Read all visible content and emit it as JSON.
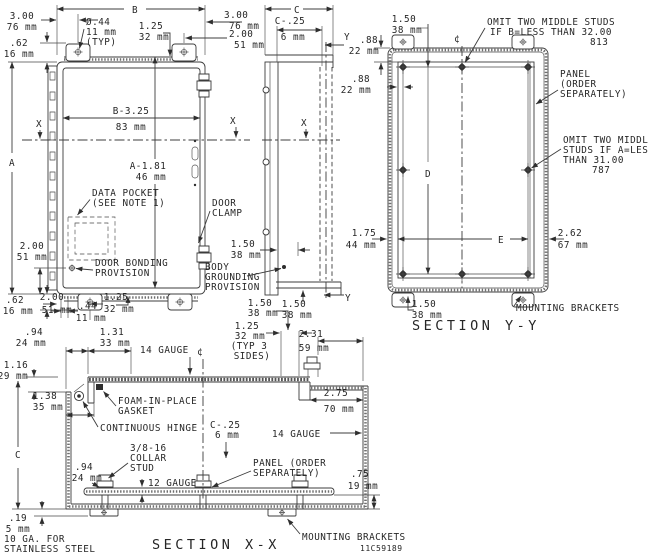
{
  "meta": {
    "drawing_number": "11C59189"
  },
  "front": {
    "dim_b": "B",
    "dim_a": "A",
    "d300_tl": [
      "3.00",
      "76 mm"
    ],
    "d62_tl": [
      ".62",
      "16 mm"
    ],
    "dia44": [
      "Ø.44",
      "11 mm",
      "(TYP)"
    ],
    "d125_top": [
      "1.25",
      "32 mm"
    ],
    "d300_tr": [
      "3.00",
      "76 mm"
    ],
    "d200_tr": [
      "2.00",
      "51 mm"
    ],
    "b325": [
      "B-3.25",
      "83 mm"
    ],
    "a181": [
      "A-1.81",
      "46 mm"
    ],
    "x_left": "X",
    "x_right": "X",
    "data_pocket": [
      "DATA POCKET",
      "(SEE NOTE 1)"
    ],
    "door_bonding": [
      "DOOR BONDING",
      "PROVISION"
    ],
    "d200_left": [
      "2.00",
      "51 mm"
    ],
    "d62_bl": [
      ".62",
      "16 mm"
    ],
    "d200_bl": [
      "2.00",
      "51 mm"
    ],
    "d44_b": [
      ".44",
      "11 mm"
    ],
    "d125_b": [
      "1.25",
      "32 mm"
    ],
    "door_clamp": [
      "DOOR",
      "CLAMP"
    ]
  },
  "side": {
    "dim_c": "C",
    "c25": [
      "C-.25",
      "6 mm"
    ],
    "y_top": "Y",
    "y_bottom": "Y",
    "x_side": "X",
    "d150_mid": [
      "1.50",
      "38 mm"
    ],
    "body_grounding": [
      "BODY",
      "GROUNDING",
      "PROVISION"
    ],
    "d150_bot": [
      "1.50",
      "38 mm"
    ]
  },
  "section_yy": {
    "title": "SECTION Y-Y",
    "d150_top": [
      "1.50",
      "38 mm"
    ],
    "d88_v": [
      ".88",
      "22 mm"
    ],
    "d88_h": [
      ".88",
      "22 mm"
    ],
    "centerline": "¢",
    "omit_b": [
      "OMIT TWO MIDDLE STUDS",
      "IF B=LESS THAN 32.00",
      "813"
    ],
    "panel": [
      "PANEL",
      "(ORDER",
      "SEPARATELY)"
    ],
    "omit_a": [
      "OMIT TWO MIDDLE",
      "STUDS IF A=LESS",
      "THAN 31.00",
      "787"
    ],
    "dim_d": "D",
    "dim_e": "E",
    "d175": [
      "1.75",
      "44 mm"
    ],
    "d262": [
      "2.62",
      "67 mm"
    ],
    "d150_bot": [
      "1.50",
      "38 mm"
    ],
    "mounting_brackets": "MOUNTING BRACKETS"
  },
  "section_xx": {
    "title": "SECTION X-X",
    "d94_top": [
      ".94",
      "24 mm"
    ],
    "d131": [
      "1.31",
      "33 mm"
    ],
    "gauge14_top": "14 GAUGE",
    "centerline": "¢",
    "d150": [
      "1.50",
      "38 mm"
    ],
    "d125_typ": [
      "1.25",
      "32 mm",
      "(TYP 3",
      "SIDES)"
    ],
    "d231": [
      "2.31",
      "59 mm"
    ],
    "d116": [
      "1.16",
      "29 mm"
    ],
    "d138": [
      "1.38",
      "35 mm"
    ],
    "foam": [
      "FOAM-IN-PLACE",
      "GASKET"
    ],
    "hinge": "CONTINUOUS HINGE",
    "c25": [
      "C-.25",
      "6 mm"
    ],
    "d275": [
      "2.75",
      "70 mm"
    ],
    "gauge14_right": "14 GAUGE",
    "collar_stud": [
      "3/8-16",
      "COLLAR",
      "STUD"
    ],
    "d94_left": [
      ".94",
      "24 mm"
    ],
    "gauge12": "12 GAUGE",
    "panel": [
      "PANEL (ORDER",
      "SEPARATELY)"
    ],
    "d75": [
      ".75",
      "19 mm"
    ],
    "dim_c": "C",
    "d19": [
      ".19",
      "5 mm"
    ],
    "ga10": [
      "10 GA. FOR",
      "STAINLESS STEEL"
    ],
    "mounting_brackets": "MOUNTING BRACKETS"
  }
}
